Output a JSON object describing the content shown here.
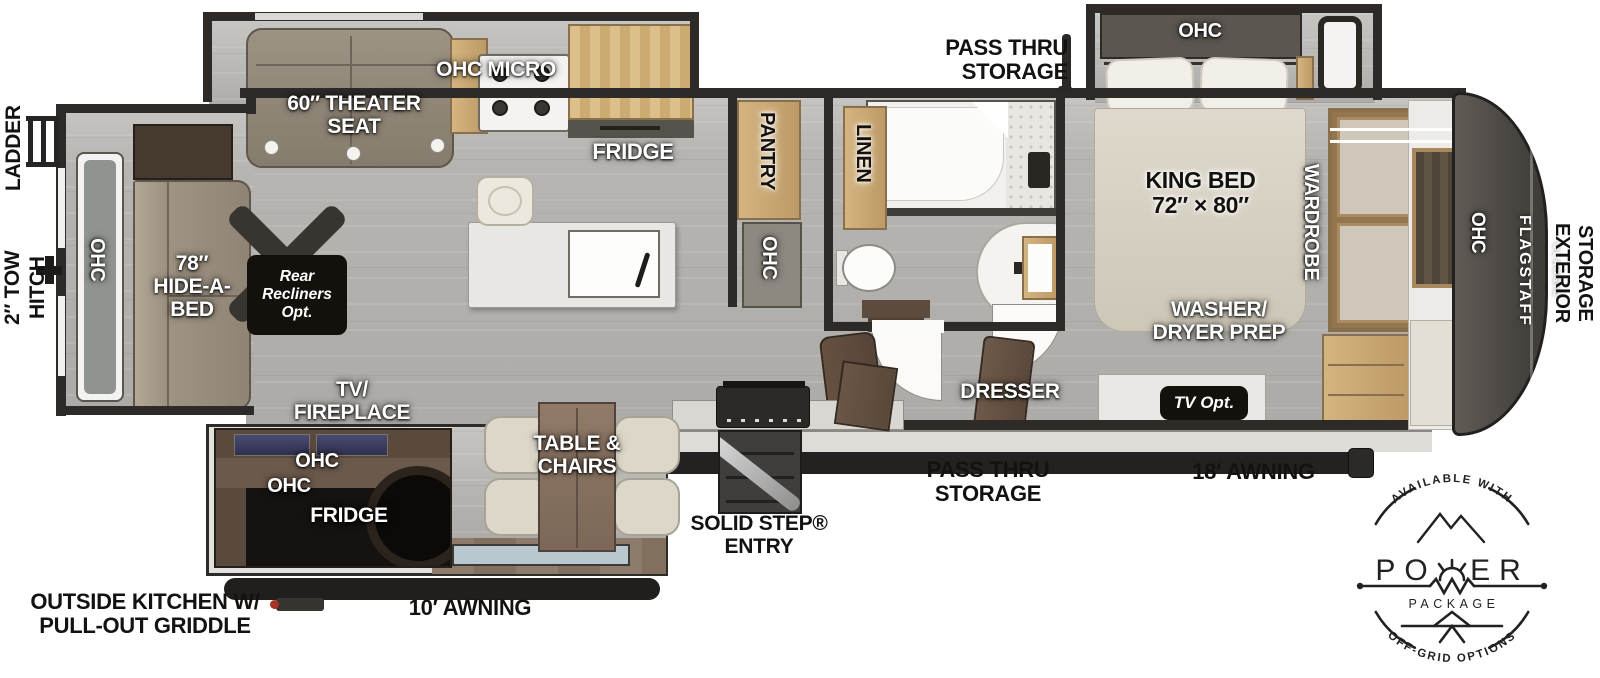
{
  "colors": {
    "wall": "#2d2a27",
    "floor": "#b4b2ae",
    "wood": "#c9a873",
    "cap": "#4a4641",
    "ink": "#141210"
  },
  "rear": {
    "ladder": "LADDER",
    "tow_hitch": "2″ TOW\nHITCH",
    "ohc": "OHC",
    "hide_a_bed": "78″\nHIDE-A-\nBED",
    "rear_recliners": "Rear\nRecliners\nOpt."
  },
  "living": {
    "theater_seat": "60″ THEATER\nSEAT",
    "ohc_micro": "OHC MICRO",
    "fridge": "FRIDGE",
    "tv_fireplace": "TV/\nFIREPLACE"
  },
  "hall": {
    "pantry": "PANTRY",
    "ohc": "OHC",
    "linen": "LINEN"
  },
  "dinette": {
    "table_chairs": "TABLE &\nCHAIRS",
    "ohc_upper": "OHC",
    "ohc_lower": "OHC",
    "fridge": "FRIDGE"
  },
  "bedroom": {
    "ohc": "OHC",
    "king_bed": "KING BED\n72″ × 80″",
    "wardrobe": "WARDROBE",
    "washer_dryer": "WASHER/\nDRYER PREP",
    "dresser": "DRESSER",
    "tv_opt": "TV Opt."
  },
  "front": {
    "ohc": "OHC",
    "brand": "FLAGSTAFF",
    "brand_sub": "CLASSIC"
  },
  "exterior": {
    "pass_thru_top": "PASS THRU\nSTORAGE",
    "outside_kitchen": "OUTSIDE KITCHEN W/\nPULL-OUT GRIDDLE",
    "awning_10": "10′ AWNING",
    "solid_step": "SOLID STEP®\nENTRY",
    "pass_thru_bottom": "PASS THRU\nSTORAGE",
    "awning_18": "18′ AWNING",
    "exterior_storage": "EXTERIOR\nSTORAGE"
  },
  "badge": {
    "arc_top": "AVAILABLE WITH",
    "power_left": "PO",
    "power_right": "ER",
    "package": "PACKAGE",
    "arc_bottom": "OFF-GRID OPTIONS"
  }
}
